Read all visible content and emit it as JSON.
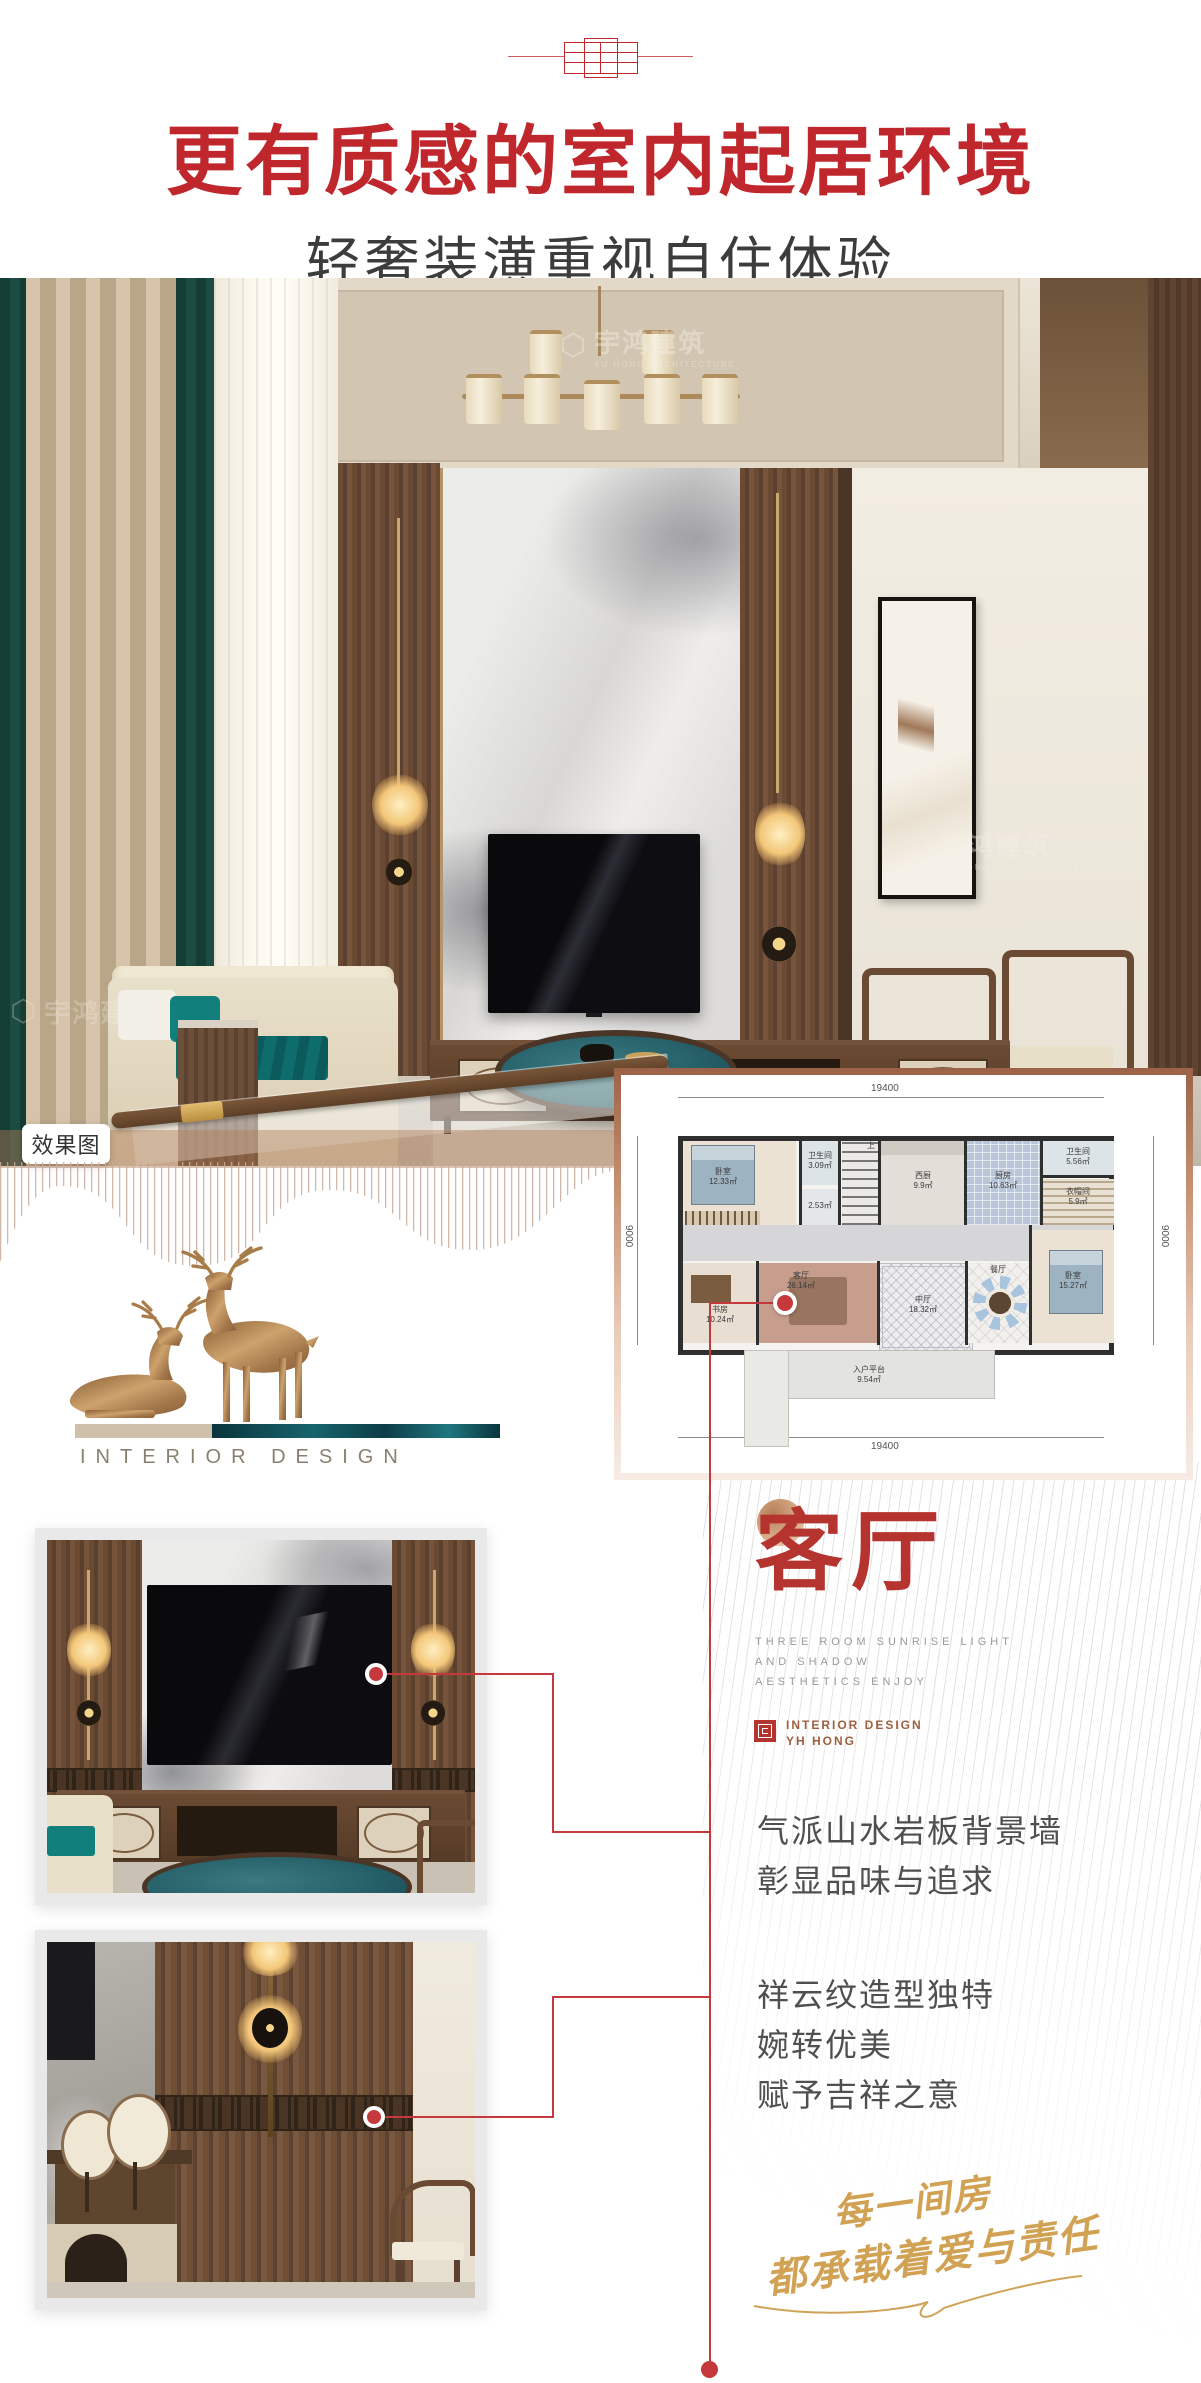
{
  "colors": {
    "accent_red": "#c0272d",
    "line_red": "#c5393c",
    "seal_red": "#b5342f",
    "gold": "#d2a254",
    "text_dark": "#3c3c3c"
  },
  "header": {
    "title": "更有质感的室内起居环境",
    "subtitle": "轻奢装潢重视自住体验"
  },
  "photo": {
    "tag": "效果图",
    "watermark_cn": "宇鸿建筑",
    "watermark_en": "YU HONG ARCHITECTURE"
  },
  "floorplan": {
    "dim_top": "19400",
    "dim_bottom": "19400",
    "dim_left": "9000",
    "dim_right": "9000",
    "stair_label": "上",
    "rooms": {
      "bed_tl": {
        "name": "卧室",
        "area": "12.33㎡"
      },
      "bath_tl": {
        "name": "卫生间",
        "area": "3.09㎡"
      },
      "shower": {
        "name": "",
        "area": "2.53㎡"
      },
      "pantry": {
        "name": "西厨",
        "area": "9.9㎡"
      },
      "kitchen": {
        "name": "厨房",
        "area": "10.63㎡"
      },
      "bath_tr": {
        "name": "卫生间",
        "area": "5.56㎡"
      },
      "cloak": {
        "name": "衣帽间",
        "area": "5.9㎡"
      },
      "bed_r": {
        "name": "卧室",
        "area": "15.27㎡"
      },
      "study": {
        "name": "书房",
        "area": "10.24㎡"
      },
      "living": {
        "name": "客厅",
        "area": "26.14㎡"
      },
      "hall": {
        "name": "中厅",
        "area": "18.32㎡"
      },
      "dining": {
        "name": "餐厅",
        "area": ""
      },
      "entry": {
        "name": "入户平台",
        "area": "9.54㎡"
      }
    }
  },
  "section": {
    "title": "客厅",
    "en_line1": "THREE ROOM SUNRISE LIGHT",
    "en_line2": "AND SHADOW",
    "en_line3": "AESTHETICS ENJOY",
    "brand_line1": "INTERIOR DESIGN",
    "brand_line2": "YH HONG"
  },
  "paragraphs": {
    "p1_line1": "气派山水岩板背景墙",
    "p1_line2": "彰显品味与追求",
    "p2_line1": "祥云纹造型独特",
    "p2_line2": "婉转优美",
    "p2_line3": "赋予吉祥之意"
  },
  "deer": {
    "caption": "INTERIOR DESIGN"
  },
  "script": {
    "line1": "每一间房",
    "line2": "都承载着爱与责任"
  }
}
